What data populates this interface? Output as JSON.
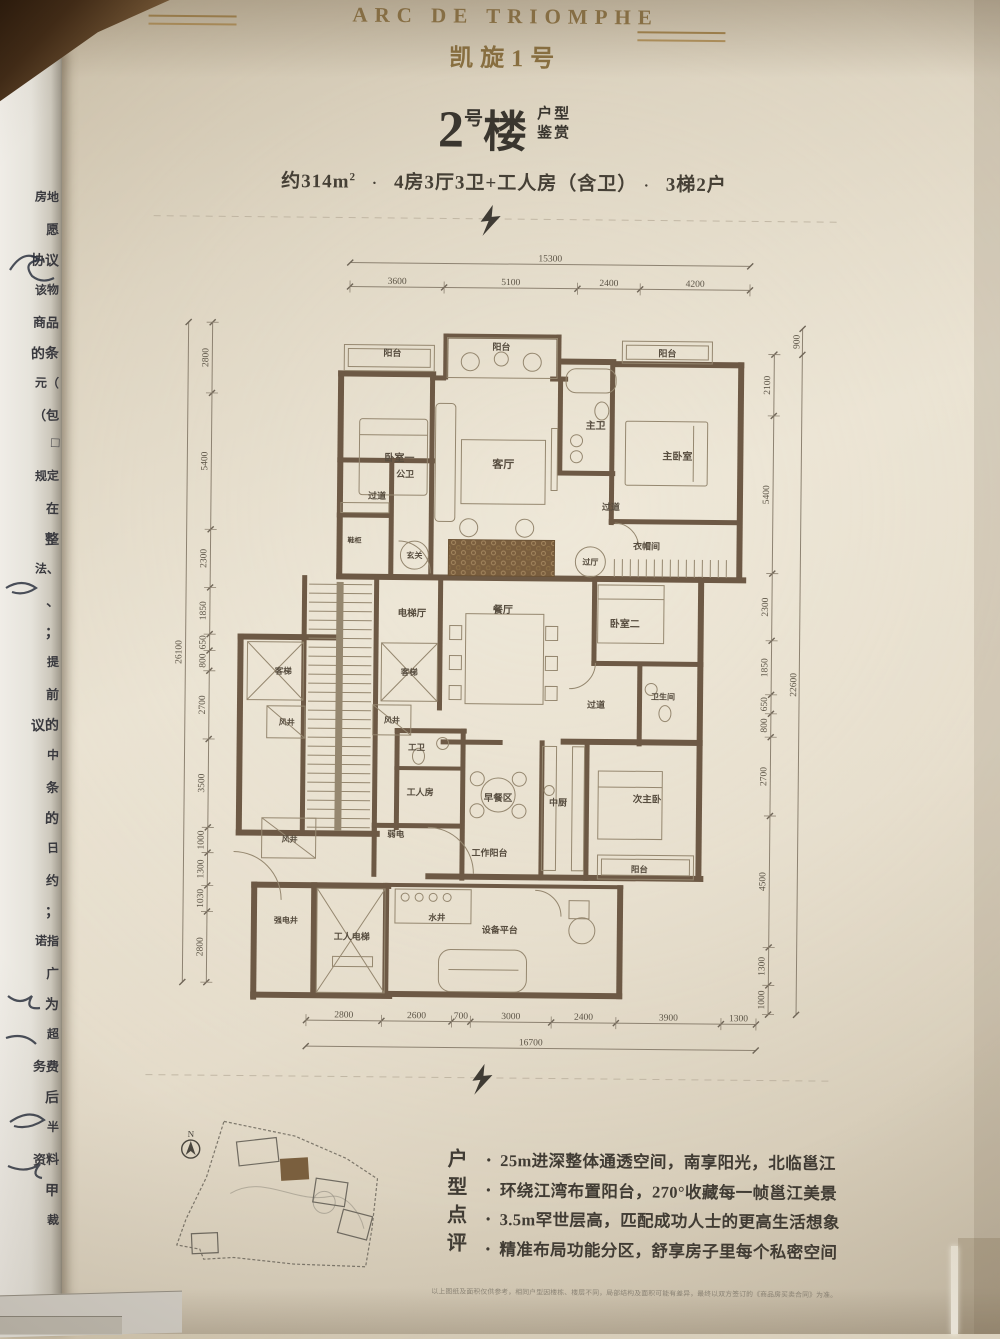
{
  "header": {
    "brand": "ARC DE TRIOMPHE",
    "brand_cn": "凯旋1号"
  },
  "title": {
    "num": "2",
    "hao": "号",
    "lou": "楼",
    "tag1": "户型",
    "tag2": "鉴赏"
  },
  "specs": {
    "area_prefix": "约314m",
    "area_sup": "2",
    "dot": "·",
    "layout": "4房3厅3卫+工人房（含卫）",
    "ratio": "3梯2户"
  },
  "plan": {
    "dims": {
      "top": {
        "overall": "15300",
        "segments": [
          "3600",
          "5100",
          "2400",
          "4200"
        ]
      },
      "bottom": {
        "overall": "16700",
        "segments": [
          "2800",
          "2600",
          "700",
          "3000",
          "2400",
          "3900",
          "1300"
        ]
      },
      "left": {
        "overall": "26100",
        "segments": [
          "2800",
          "5400",
          "2300",
          "1850",
          "650",
          "800",
          "2700",
          "3500",
          "1000",
          "1300",
          "1030",
          "2800"
        ]
      },
      "right": {
        "overall": "22600",
        "extra_top": "900",
        "segments": [
          "2100",
          "5400",
          "2300",
          "1850",
          "650",
          "800",
          "2700",
          "4500",
          "1300",
          "1000"
        ]
      }
    },
    "rooms": [
      {
        "t": "阳台",
        "x": 390,
        "y": 357,
        "s": 9
      },
      {
        "t": "阳台",
        "x": 499,
        "y": 350,
        "s": 9
      },
      {
        "t": "阳台",
        "x": 665,
        "y": 355,
        "s": 9
      },
      {
        "t": "卧室一",
        "x": 398,
        "y": 462,
        "s": 10
      },
      {
        "t": "客厅",
        "x": 502,
        "y": 468,
        "s": 11
      },
      {
        "t": "主卫",
        "x": 594,
        "y": 428,
        "s": 10
      },
      {
        "t": "主卧室",
        "x": 676,
        "y": 458,
        "s": 10
      },
      {
        "t": "公卫",
        "x": 404,
        "y": 478,
        "s": 9
      },
      {
        "t": "过道",
        "x": 376,
        "y": 500,
        "s": 9
      },
      {
        "t": "鞋柜",
        "x": 354,
        "y": 544,
        "s": 7
      },
      {
        "t": "玄关",
        "x": 414,
        "y": 559,
        "s": 8
      },
      {
        "t": "过道",
        "x": 610,
        "y": 509,
        "s": 9
      },
      {
        "t": "衣帽间",
        "x": 646,
        "y": 548,
        "s": 9
      },
      {
        "t": "过厅",
        "x": 590,
        "y": 564,
        "s": 8
      },
      {
        "t": "电梯厅",
        "x": 412,
        "y": 617,
        "s": 9.5
      },
      {
        "t": "餐厅",
        "x": 503,
        "y": 613,
        "s": 10
      },
      {
        "t": "客梯",
        "x": 284,
        "y": 676,
        "s": 8.5
      },
      {
        "t": "客梯",
        "x": 410,
        "y": 676,
        "s": 8.5
      },
      {
        "t": "卧室二",
        "x": 625,
        "y": 626,
        "s": 10
      },
      {
        "t": "过道",
        "x": 597,
        "y": 707,
        "s": 9
      },
      {
        "t": "卫生间",
        "x": 664,
        "y": 698,
        "s": 8
      },
      {
        "t": "风井",
        "x": 288,
        "y": 727,
        "s": 8
      },
      {
        "t": "风井",
        "x": 393,
        "y": 724,
        "s": 8
      },
      {
        "t": "工卫",
        "x": 418,
        "y": 751,
        "s": 8.5
      },
      {
        "t": "工人房",
        "x": 422,
        "y": 796,
        "s": 9
      },
      {
        "t": "早餐区",
        "x": 500,
        "y": 801,
        "s": 9.5
      },
      {
        "t": "中厨",
        "x": 560,
        "y": 805,
        "s": 9
      },
      {
        "t": "次主卧",
        "x": 649,
        "y": 801,
        "s": 9.5
      },
      {
        "t": "风井",
        "x": 292,
        "y": 844,
        "s": 8
      },
      {
        "t": "弱电",
        "x": 398,
        "y": 838,
        "s": 8.5
      },
      {
        "t": "工作阳台",
        "x": 492,
        "y": 856,
        "s": 9
      },
      {
        "t": "阳台",
        "x": 642,
        "y": 871,
        "s": 8.5
      },
      {
        "t": "强电井",
        "x": 289,
        "y": 925,
        "s": 8
      },
      {
        "t": "工人电梯",
        "x": 355,
        "y": 941,
        "s": 9
      },
      {
        "t": "水井",
        "x": 440,
        "y": 921,
        "s": 8.5
      },
      {
        "t": "设备平台",
        "x": 503,
        "y": 933,
        "s": 9
      }
    ]
  },
  "sitemap": {
    "north_label": "N"
  },
  "review": {
    "title_chars": [
      "户",
      "型",
      "点",
      "评"
    ],
    "bullet_glyph": "•",
    "bullets": [
      "25m进深整体通透空间，南享阳光，北临邕江",
      "环绕江湾布置阳台，270°收藏每一帧邕江美景",
      "3.5m罕世层高，匹配成功人士的更高生活想象",
      "精准布局功能分区，舒享房子里每个私密空间"
    ]
  },
  "disclaimer": "以上图纸及面积仅供参考，相同户型因楼栋、楼层不同，局部结构及面积可能有差异，最终以双方签订的《商品房买卖合同》为准。",
  "photo": {
    "left_doc_fragments": [
      "房地",
      "愿",
      "协议",
      "该物",
      "商品",
      "的条",
      "元（",
      "（包",
      "□",
      "规定",
      "在",
      "整",
      "法、",
      "、",
      "；",
      "提",
      "前",
      "议的",
      "中",
      "条",
      "的",
      "日",
      "约",
      "；",
      "诺指",
      "广",
      "为",
      "超",
      "务费",
      "后",
      "半",
      "资料",
      "甲",
      "裁"
    ]
  }
}
